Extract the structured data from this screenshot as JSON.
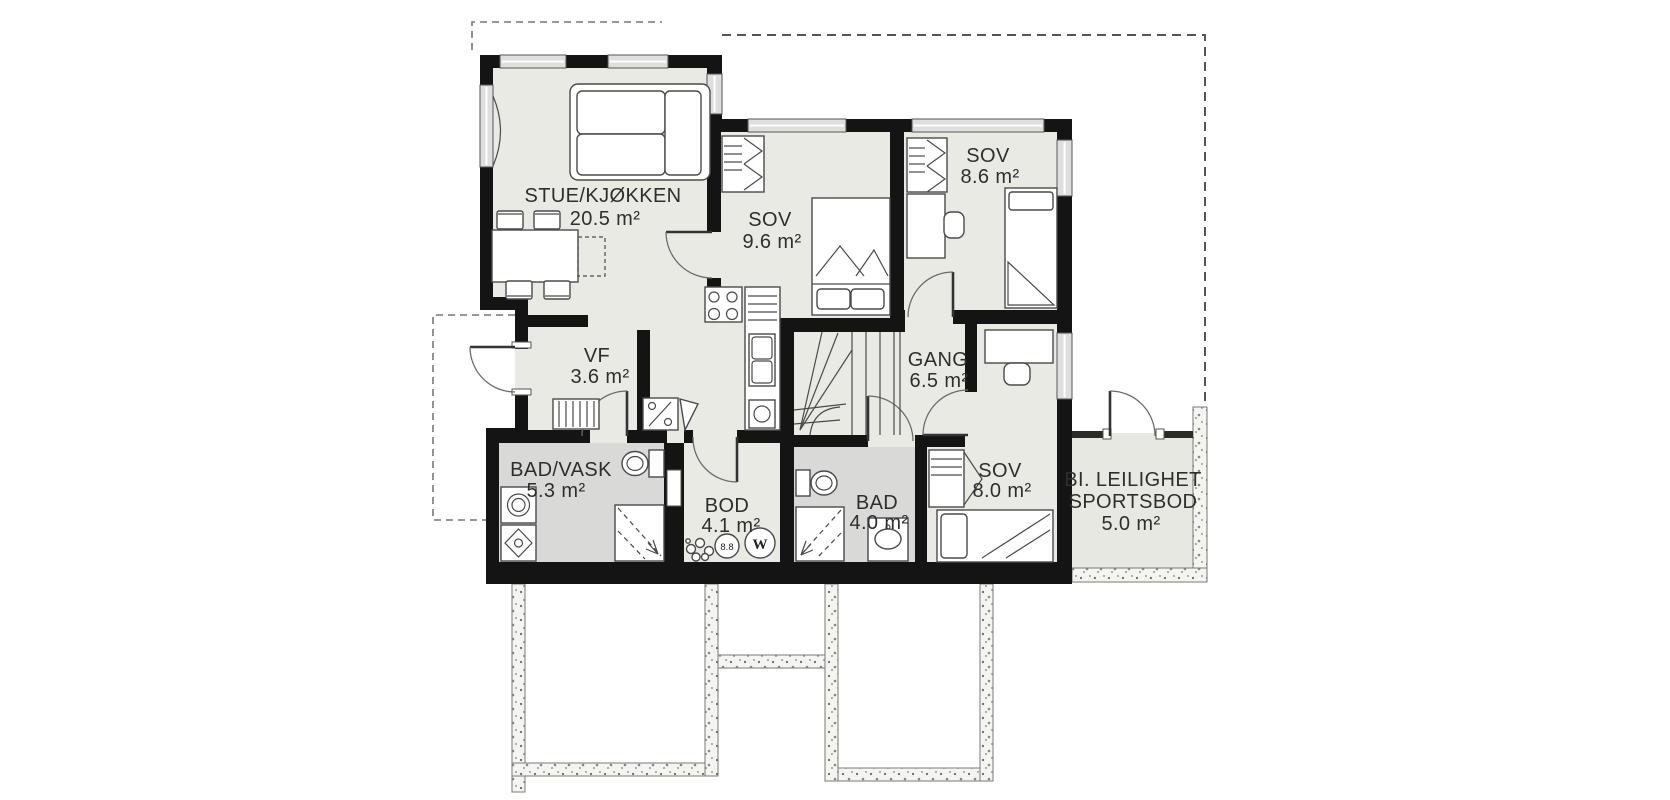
{
  "plan": {
    "rooms": [
      {
        "name": "STUE/KJØKKEN",
        "area": "20.5 m²"
      },
      {
        "name": "SOV",
        "area": "9.6 m²"
      },
      {
        "name": "SOV",
        "area": "8.6 m²"
      },
      {
        "name": "VF",
        "area": "3.6 m²"
      },
      {
        "name": "GANG",
        "area": "6.5 m²"
      },
      {
        "name": "BAD/VASK",
        "area": "5.3 m²"
      },
      {
        "name": "BOD",
        "area": "4.1 m²"
      },
      {
        "name": "BAD",
        "area": "4.0 m²"
      },
      {
        "name": "SOV",
        "area": "8.0 m²"
      },
      {
        "name_line1": "BI. LEILIGHET",
        "name_line2": "SPORTSBOD",
        "area": "5.0 m²"
      }
    ],
    "markers": {
      "drain_label": "8.8",
      "water_heater_label": "W"
    },
    "colors": {
      "wall": "#141414",
      "floor": "#eaeae5",
      "wet_room_floor": "#d9d9d8",
      "annex_floor": "#e8e8e2",
      "window": "#dedede",
      "background": "#ffffff",
      "label_text": "#2e2e2e"
    }
  }
}
